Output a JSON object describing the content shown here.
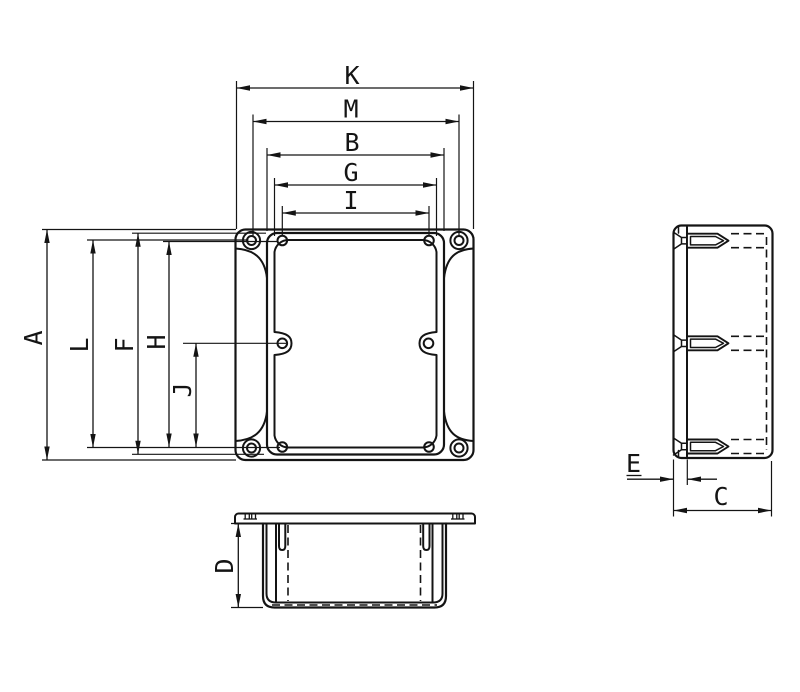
{
  "colors": {
    "background": "#ffffff",
    "ink": "#141414"
  },
  "dimension_labels": {
    "K": "K",
    "M": "M",
    "B": "B",
    "G": "G",
    "I": "I",
    "A": "A",
    "L": "L",
    "F": "F",
    "H": "H",
    "J": "J",
    "D": "D",
    "E": "E",
    "C": "C"
  }
}
